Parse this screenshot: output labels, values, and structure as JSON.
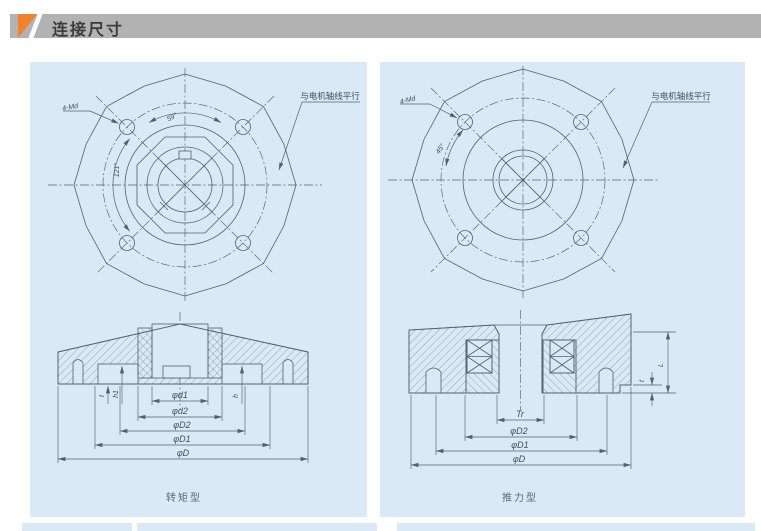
{
  "header": {
    "title": "连接尺寸",
    "bar_color": "#b2b2b2",
    "accent_color": "#f08329",
    "text_color": "#3b3b3b"
  },
  "colors": {
    "page_bg": "#ffffff",
    "panel_bg": "#d9eaf6",
    "line": "#51616e"
  },
  "left_drawing": {
    "caption": "转矩型",
    "labels": {
      "bolt_holes": "4-Md",
      "angle_top": "59°",
      "angle_side": "121°",
      "leader_note": "与电机轴线平行",
      "d1": "φd1",
      "d2": "φd2",
      "D2": "φD2",
      "D1": "φD1",
      "D": "φD",
      "t": "t",
      "h1": "h1",
      "h": "h"
    }
  },
  "right_drawing": {
    "caption": "推力型",
    "labels": {
      "bolt_holes": "4-Md",
      "angle": "45°",
      "leader_note": "与电机轴线平行",
      "Tr": "Tr",
      "D2": "φD2",
      "D1": "φD1",
      "D": "φD",
      "L": "L",
      "t": "t"
    }
  }
}
